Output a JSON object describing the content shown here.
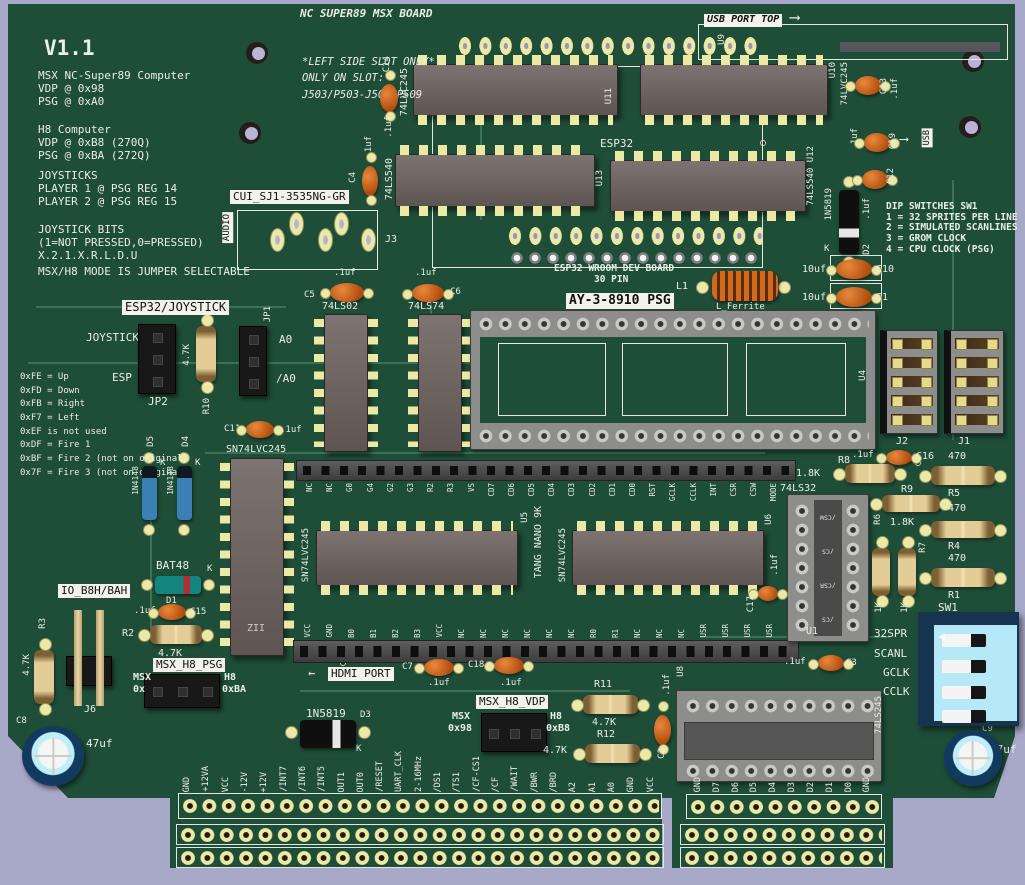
{
  "colors": {
    "pcb_green": "#1e4d38",
    "silkscreen": "#e9efe6",
    "background": "#a8a8c9",
    "pad_yellow": "#ece8a6",
    "dip_switch_face": "#b5e9f8"
  },
  "board": {
    "title": "NC SUPER89 MSX BOARD",
    "version": "V1.1",
    "usb_port_top": "USB PORT TOP",
    "arrow_right": "⟶",
    "arrow_left": "←",
    "usb_vertical": "USB"
  },
  "notes": {
    "msx": [
      "MSX NC-Super89 Computer",
      "VDP @ 0x98",
      "PSG @ 0xA0"
    ],
    "h8": [
      "H8 Computer",
      "VDP @ 0xB8 (270Q)",
      "PSG @ 0xBA (272Q)"
    ],
    "joysticks": [
      "JOYSTICKS",
      "PLAYER 1 @ PSG REG 14",
      "PLAYER 2 @ PSG REG 15"
    ],
    "joystick_bits": [
      "JOYSTICK BITS",
      "(1=NOT PRESSED,0=PRESSED)",
      "X.2.1.X.R.L.D.U"
    ],
    "mode": "MSX/H8 MODE IS JUMPER SELECTABLE",
    "bit_codes": [
      "0xFE = Up",
      "0xFD = Down",
      "0xFB = Right",
      "0xF7 = Left",
      "0xEF is not used",
      "0xDF = Fire 1",
      "0xBF = Fire 2 (not on original)",
      "0x7F = Fire 3 (not on original)"
    ],
    "slot": [
      "*LEFT SIDE SLOT ONLY*",
      "ONLY ON SLOT:",
      "J503/P503-J509/P509"
    ],
    "dip": [
      "DIP SWITCHES SW1",
      "1 = 32 SPRITES PER LINE",
      "2 = SIMULATED SCANLINES",
      "3 = GROM CLOCK",
      "4 = CPU CLOCK (PSG)"
    ]
  },
  "esp32": {
    "label": "ESP32",
    "board_name": "ESP32 WROOM DEV BOARD",
    "pins": "30 PIN",
    "u9": "U9",
    "u11_part": "74LVC245",
    "u11_ref": "U11",
    "u10_ref": "U10",
    "u10_part": "74LVC245",
    "u13_part": "74LS540",
    "u13_ref": "U13",
    "u12_label": "74LS540 U12",
    "c14": "C14",
    "c14_v": ".1uf",
    "c4": "C4",
    "c4_v": ".1uf"
  },
  "audio": {
    "part": "CUI_SJ1-3535NG-GR",
    "label": "AUDIO",
    "ref": "J3"
  },
  "logic": {
    "c5": "C5",
    "c5_v": ".1uf",
    "ls02": "74LS02",
    "c6": "C6",
    "c6_v": ".1uf",
    "ls74": "74LS74"
  },
  "psg": {
    "label": "AY-3-8910 PSG",
    "u4": "U4",
    "l1": "L1",
    "l1_part": "L_Ferrite",
    "c10": "C10",
    "c10_v": "10uf",
    "c1": "C1",
    "c1_v": "10uf",
    "j2": "J2",
    "j1": "J1"
  },
  "right_top": {
    "c13": "C13",
    "c13_v": ".1uf",
    "c19": "C19",
    "c19_v": ".1uf",
    "c12": "C12",
    "d2": "D2",
    "d2_part": "1N5819",
    "d2_k": "K",
    "d2_c": ".1uf"
  },
  "jumpers": {
    "esp32_joystick": "ESP32/JOYSTICK",
    "joystick": "JOYSTICK",
    "esp": "ESP",
    "jp2": "JP2",
    "r10": "R10",
    "r10_v": "4.7K",
    "jp1": "JP1",
    "psg_ctl": "PSG CTL",
    "a0": "A0",
    "na0": "/A0",
    "c11": "C11",
    "c11_v": ".1uf",
    "buf": "SN74LVC245",
    "zii": "ZII",
    "d5": "D5",
    "d5_part": "1N4148",
    "d4": "D4",
    "d4_part": "1N4148",
    "k": "K"
  },
  "tang": {
    "u5": "U5",
    "u5_part": "SN74LVC245",
    "name": "TANG NANO 9K",
    "u6": "U6",
    "u6_part": "SN74LVC245",
    "c17": "C17",
    "c17_v": ".1uf",
    "top_pins": [
      "NC",
      "NC",
      "G0",
      "G4",
      "G2",
      "G3",
      "R2",
      "R3",
      "VS",
      "CD7",
      "CD6",
      "CD5",
      "CD4",
      "CD3",
      "CD2",
      "CD1",
      "CD0",
      "RST",
      "GCLK",
      "CCLK",
      "INT",
      "CSR",
      "CSW",
      "MODE"
    ],
    "bottom_pins": [
      "VCC",
      "GND",
      "B0",
      "B1",
      "B2",
      "B3",
      "VCC",
      "NC",
      "NC",
      "NC",
      "NC",
      "NC",
      "NC",
      "R0",
      "R1",
      "NC",
      "NC",
      "NC",
      "USR",
      "USR",
      "USR",
      "USR"
    ]
  },
  "glue": {
    "u1_part": "74LS32",
    "u1": "U1",
    "u1_pins": [
      "/CSW",
      "/CS",
      "/CSR",
      "/CS"
    ],
    "r8": "R8",
    "r8_v": "1.8K",
    "c16": "C16",
    "c16_v": ".1uf",
    "r5": "R5",
    "r5_v": "470",
    "r9": "R9",
    "r9_v": "1.8K",
    "r6": "R6",
    "r6_v": "1K",
    "r7": "R7",
    "r7_v": "1K",
    "r4": "R4",
    "r4_v": "470",
    "r1": "R1",
    "r1_v": "470",
    "sw1": "SW1",
    "sw_labels": [
      "32SPR",
      "SCANL",
      "GCLK",
      "CCLK"
    ],
    "c3": "C3",
    "c3_v": ".1uf"
  },
  "bottom_left": {
    "d1": "D1",
    "d1_part": "BAT48",
    "k": "K",
    "c15": "C15",
    "c15_v": ".1uf",
    "r2": "R2",
    "r2_v": "4.7K",
    "r3": "R3",
    "r3_v": "4.7K",
    "io": "IO_B8H/BAH",
    "j6": "J6",
    "psg_sel": "MSX_H8_PSG",
    "msx": "MSX",
    "msx_addr": "0x",
    "h8": "H8",
    "h8_addr": "0xBA",
    "jp3": "JP3",
    "c8": "C8",
    "c8_v": "47uf"
  },
  "bottom_mid": {
    "hdmi": "HDMI PORT",
    "c7": "C7",
    "c7_v": ".1uf",
    "c18": "C18",
    "c18_v": ".1uf",
    "d3": "D3",
    "d3_part": "1N5819",
    "k": "K",
    "vdp_sel": "MSX_H8_VDP",
    "msx": "MSX",
    "msx_addr": "0x98",
    "h8": "H8",
    "h8_addr": "0xB8",
    "r11": "R11",
    "r11_v": "4.7K",
    "r12": "R12",
    "r12_v": "4.7K"
  },
  "bottom_right": {
    "u8": "U8",
    "u8_part": "74LS245",
    "c2": "C2",
    "c2_v": ".1uf",
    "c9": "C9",
    "c9_v": "47uf",
    "pins": [
      "GND",
      "D7",
      "D6",
      "D5",
      "D4",
      "D3",
      "D2",
      "D1",
      "D0",
      "GND"
    ]
  },
  "expansion": {
    "pins": [
      "GND",
      "+12VA",
      "VCC",
      "-12V",
      "+12V",
      "/INT7",
      "/INT6",
      "/INT5",
      "OUT1",
      "OUT0",
      "/RESET",
      "UART_CLK",
      "2-16MHz",
      "/DS1",
      "/TS1",
      "/CF-CS1",
      "/CF",
      "/WAIT",
      "/BWR",
      "/BRD",
      "A2",
      "A1",
      "A0",
      "GND",
      "VCC"
    ]
  }
}
